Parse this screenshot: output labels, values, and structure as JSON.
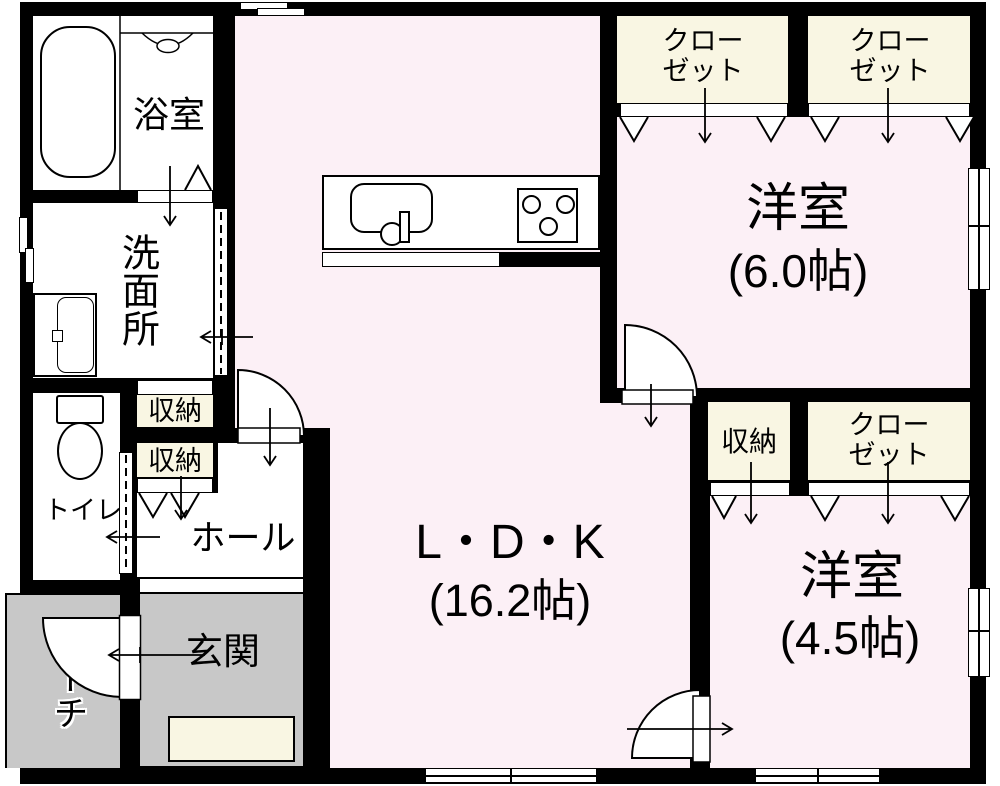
{
  "plan": {
    "type": "floor-plan",
    "rooms": {
      "bathroom": {
        "label": "浴室"
      },
      "washroom": {
        "label": "洗面所"
      },
      "toilet": {
        "label": "トイレ"
      },
      "storage_upper": {
        "label": "収納"
      },
      "storage_lower": {
        "label": "収納"
      },
      "hall": {
        "label": "ホール"
      },
      "entrance": {
        "label": "玄関"
      },
      "porch": {
        "label": "ポーチ"
      },
      "ldk": {
        "label": "L・D・K",
        "size": "(16.2帖)"
      },
      "bedroom_large": {
        "label": "洋室",
        "size": "(6.0帖)"
      },
      "bedroom_small": {
        "label": "洋室",
        "size": "(4.5帖)"
      },
      "closet_top_left": {
        "line1": "クロー",
        "line2": "ゼット"
      },
      "closet_top_right": {
        "line1": "クロー",
        "line2": "ゼット"
      },
      "closet_mid": {
        "line1": "クロー",
        "line2": "ゼット"
      },
      "storage_mid": {
        "label": "収納"
      }
    },
    "colors": {
      "wall": "#000000",
      "floor": "#ffffff",
      "pink": "#fcf0f6",
      "cream": "#f9f6e3",
      "gray": "#c8c8c8"
    }
  }
}
